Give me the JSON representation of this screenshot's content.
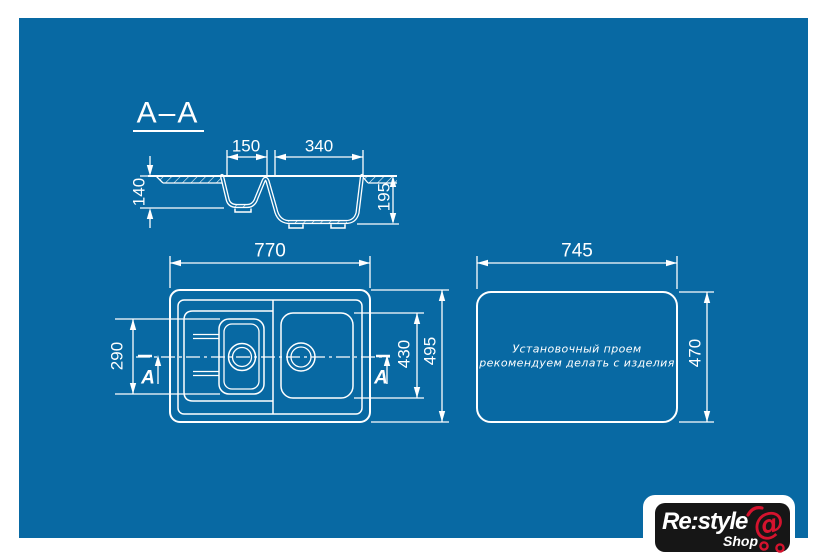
{
  "colors": {
    "page_bg": "#ffffff",
    "blueprint_bg": "#0869a3",
    "line": "#ffffff",
    "logo_bg": "#161616",
    "logo_red": "#d5132e"
  },
  "section_view": {
    "title": "A–A",
    "dim_small_bowl_width": "150",
    "dim_large_bowl_width": "340",
    "dim_left_depth": "140",
    "dim_right_depth": "195"
  },
  "plan_view": {
    "dim_overall_length": "770",
    "dim_left_section": "290",
    "dim_bowl_section": "430",
    "dim_overall_width": "495",
    "section_letter_left": "A",
    "section_letter_right": "A"
  },
  "cutout_view": {
    "dim_length": "745",
    "dim_width": "470",
    "note_line1": "Установочный проем",
    "note_line2": "рекомендуем делать с изделия"
  },
  "logo": {
    "brand": "Re:style",
    "sub": "Shop",
    "symbol": "@"
  }
}
